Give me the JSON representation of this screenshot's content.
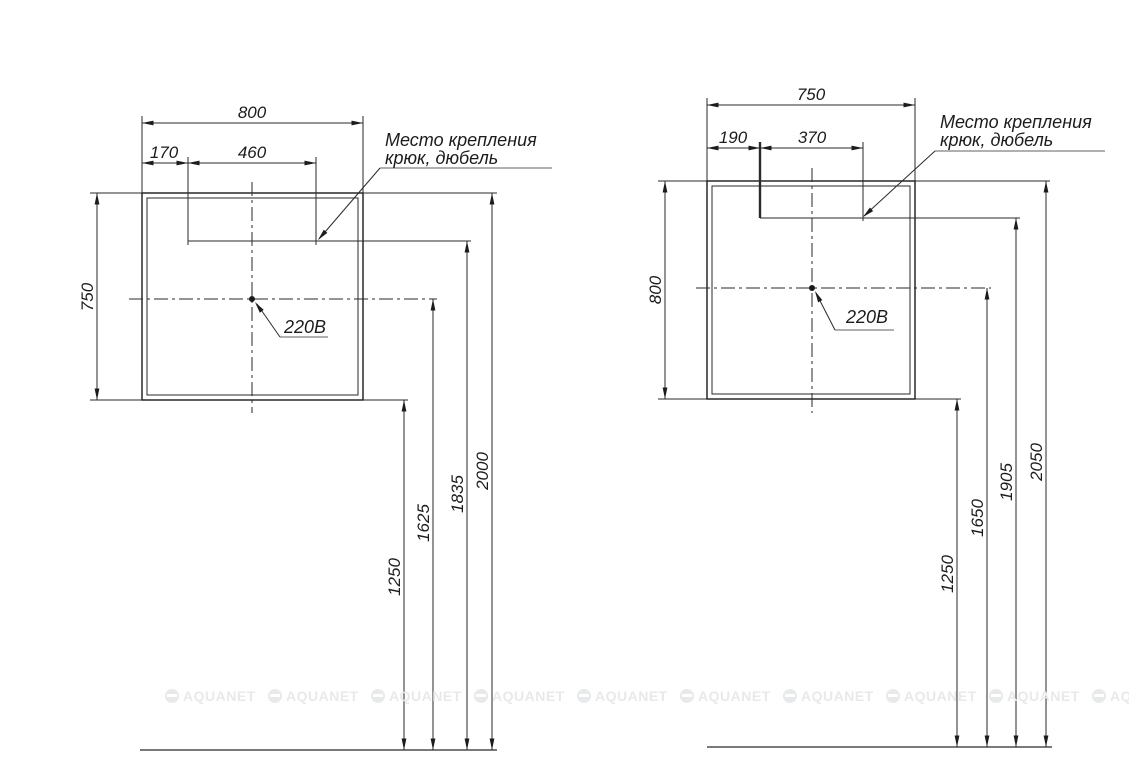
{
  "left": {
    "top_width": "800",
    "mount_offset": "170",
    "mount_span": "460",
    "side_height": "750",
    "note1": "Место крепления",
    "note2": "крюк, дюбель",
    "outlet": "220В",
    "heights": [
      "1250",
      "1625",
      "1835",
      "2000"
    ]
  },
  "right": {
    "top_width": "750",
    "mount_offset": "190",
    "mount_span": "370",
    "side_height": "800",
    "note1": "Место крепления",
    "note2": "крюк, дюбель",
    "outlet": "220В",
    "heights": [
      "1250",
      "1650",
      "1905",
      "2050"
    ]
  },
  "watermark": {
    "text": "AQUANET"
  },
  "colors": {
    "line": "#2a2a2a",
    "underline": "#b0b0b0",
    "watermark": "#e7e9eb"
  }
}
